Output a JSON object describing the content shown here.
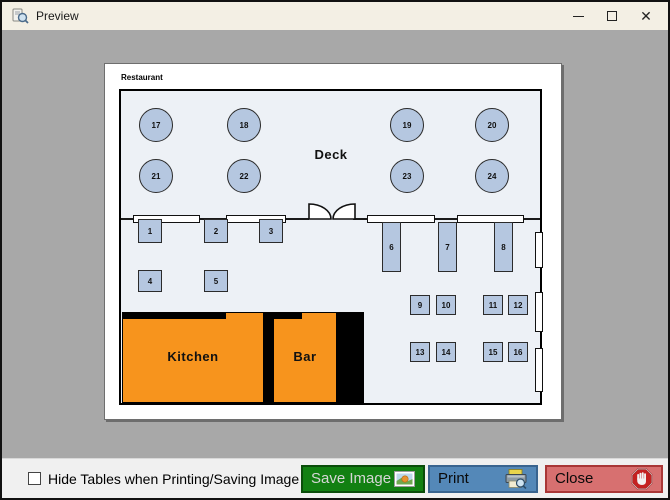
{
  "window": {
    "title": "Preview",
    "controls": {
      "minimize": "minimize",
      "maximize": "maximize",
      "close": "close"
    }
  },
  "floorplan": {
    "sheet_label": "Restaurant",
    "areas": {
      "deck": "Deck",
      "kitchen": "Kitchen",
      "bar": "Bar"
    },
    "round_tables": [
      "17",
      "18",
      "19",
      "20",
      "21",
      "22",
      "23",
      "24"
    ],
    "window_wall_tables": [
      "1",
      "2",
      "3"
    ],
    "floor_tables": [
      "4",
      "5"
    ],
    "long_tables": [
      "6",
      "7",
      "8"
    ],
    "small_tables_row1": [
      "9",
      "10",
      "11",
      "12"
    ],
    "small_tables_row2": [
      "13",
      "14",
      "15",
      "16"
    ]
  },
  "footer": {
    "hide_tables_checkbox": {
      "label": "Hide Tables when Printing/Saving Image",
      "checked": false
    },
    "buttons": {
      "save": "Save Image",
      "print": "Print",
      "close": "Close"
    }
  },
  "colors": {
    "titlebar": "#f3efe4",
    "canvas_gray": "#a8a8a8",
    "floor": "#edf1f6",
    "table_blue": "#b5c7e0",
    "kitchen_orange": "#f7941d",
    "save_green": "#128012",
    "print_blue": "#5488b8",
    "close_red": "#d77070"
  }
}
